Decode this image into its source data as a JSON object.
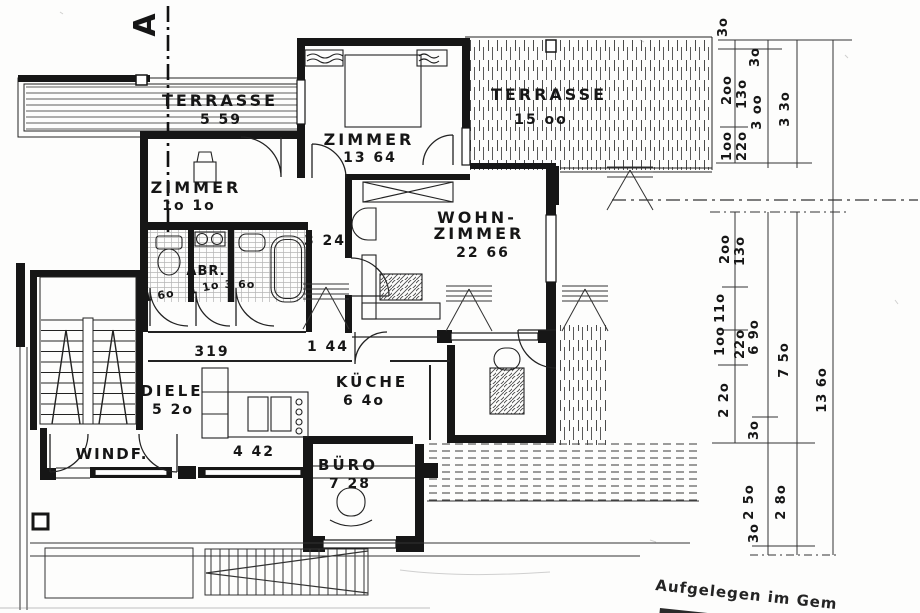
{
  "section": {
    "marker": "A"
  },
  "rooms": {
    "terrasse_west": {
      "name": "TERRASSE",
      "area": "5 59"
    },
    "zimmer_nord": {
      "name": "ZIMMER",
      "area": "13 64"
    },
    "terrasse_ost": {
      "name": "TERRASSE",
      "area": "15 oo"
    },
    "zimmer_west": {
      "name": "ZIMMER",
      "area": "1o 1o"
    },
    "wohnzimmer": {
      "name_line1": "WOHN-",
      "name_line2": "ZIMMER",
      "area": "22 66"
    },
    "wc": {
      "area": "1 6o"
    },
    "abstellraum": {
      "name": "ABR.",
      "area": "1 1o"
    },
    "bad": {
      "area": "3 6o"
    },
    "flur_oben": {
      "area": "3 24"
    },
    "flur": {
      "area": "319"
    },
    "flur_klein": {
      "area": "1 44"
    },
    "diele": {
      "name": "DIELE",
      "area": "5 2o"
    },
    "kueche": {
      "name": "KÜCHE",
      "area": "6 4o"
    },
    "windfang": {
      "name": "WINDF."
    },
    "essplatz": {
      "area": "4 42"
    },
    "buero": {
      "name": "BÜRO",
      "area": "7 28"
    }
  },
  "dims": {
    "top": [
      {
        "t": "3o"
      },
      {
        "t": "2oo"
      },
      {
        "t": "1oo"
      },
      {
        "t": "3o"
      },
      {
        "t": "13o"
      },
      {
        "t": "22o"
      },
      {
        "t": "3 oo"
      },
      {
        "t": "3 3o"
      }
    ],
    "middle": [
      {
        "t": "2oo"
      },
      {
        "t": "13o"
      },
      {
        "t": "11o"
      },
      {
        "t": "1oo"
      },
      {
        "t": "22o"
      },
      {
        "t": "6 9o"
      },
      {
        "t": "7 5o"
      },
      {
        "t": "2 2o"
      },
      {
        "t": "3o"
      },
      {
        "t": "13 6o"
      }
    ],
    "bottom": [
      {
        "t": "2 5o"
      },
      {
        "t": "2 8o"
      },
      {
        "t": "3o"
      }
    ]
  },
  "stamp": {
    "line1": "Aufgelegen im Gem"
  },
  "colors": {
    "ink": "#161616",
    "hatch": "#4a4a4a",
    "tile": "#b5b5b5"
  }
}
